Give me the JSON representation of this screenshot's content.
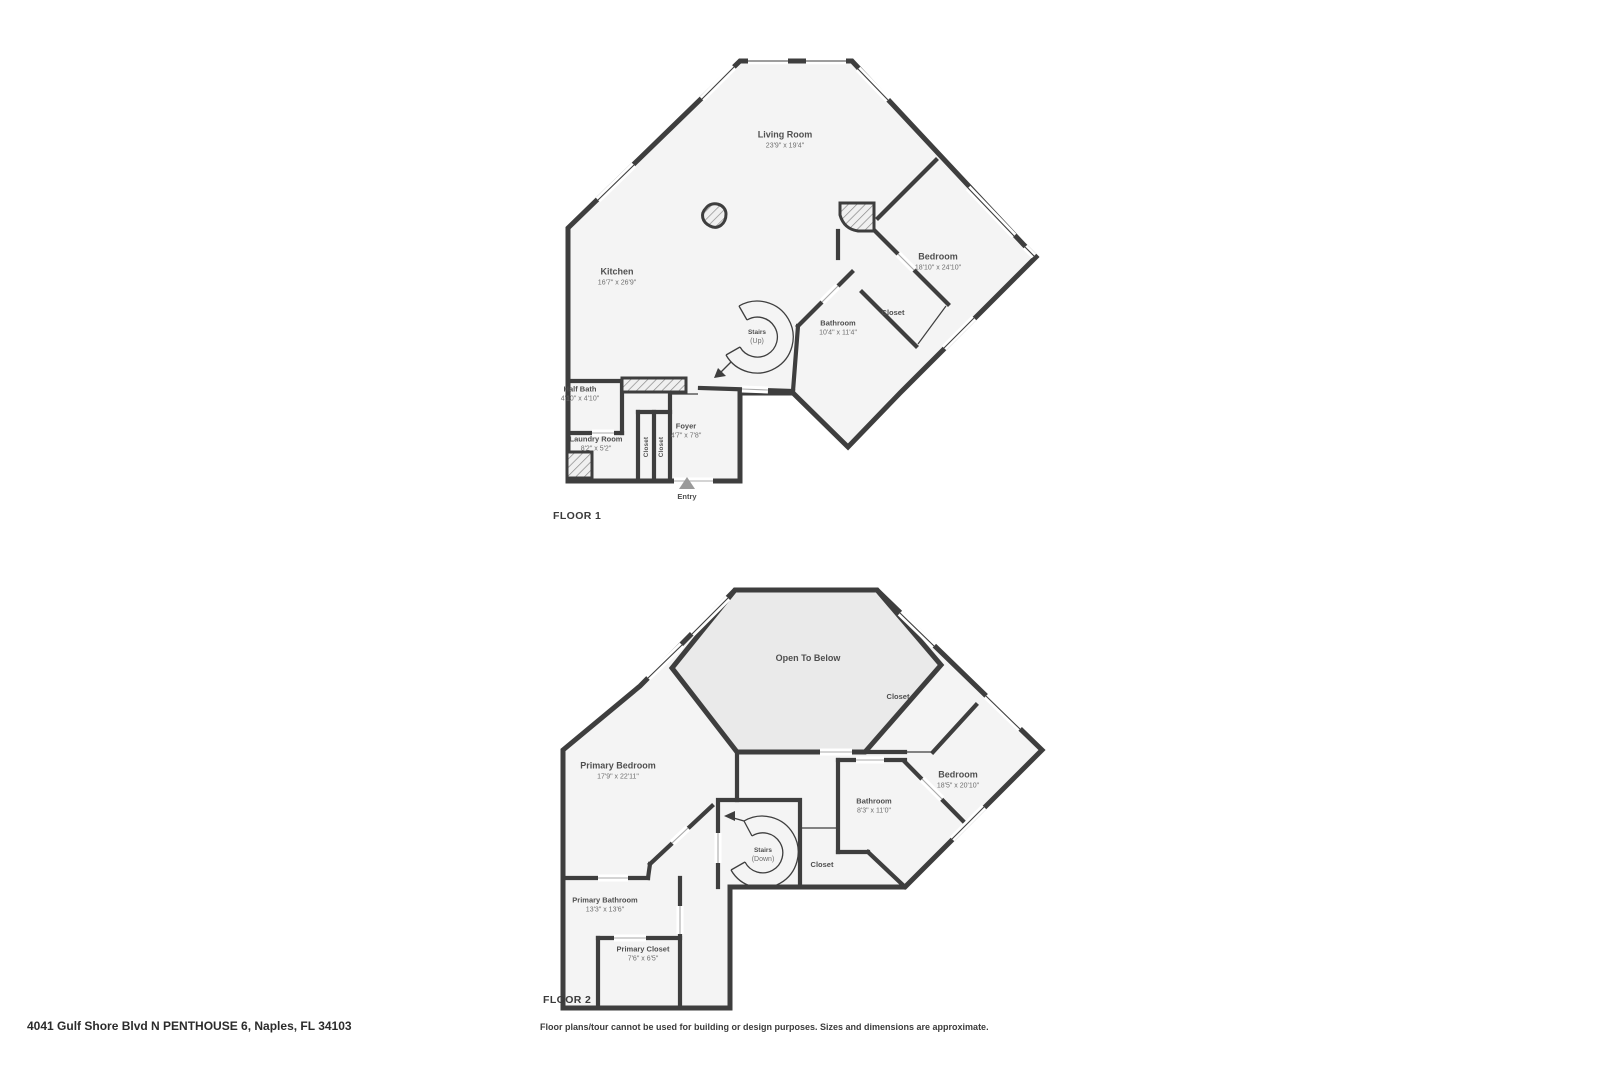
{
  "floor1": {
    "label": "FLOOR 1",
    "rooms": [
      {
        "name": "Living Room",
        "dims": "23'9\" x 19'4\""
      },
      {
        "name": "Kitchen",
        "dims": "16'7\" x 26'9\""
      },
      {
        "name": "Bedroom",
        "dims": "18'10\" x 24'10\""
      },
      {
        "name": "Bathroom",
        "dims": "10'4\" x 11'4\""
      },
      {
        "name": "Closet",
        "dims": ""
      },
      {
        "name": "Half Bath",
        "dims": "4'10\" x 4'10\""
      },
      {
        "name": "Laundry Room",
        "dims": "8'2\" x 5'2\""
      },
      {
        "name": "Closet",
        "dims": ""
      },
      {
        "name": "Closet",
        "dims": ""
      },
      {
        "name": "Foyer",
        "dims": "4'7\" x 7'8\""
      },
      {
        "name": "Stairs",
        "dims": "(Up)"
      },
      {
        "name": "Entry",
        "dims": ""
      }
    ]
  },
  "floor2": {
    "label": "FLOOR 2",
    "rooms": [
      {
        "name": "Open To Below",
        "dims": ""
      },
      {
        "name": "Closet",
        "dims": ""
      },
      {
        "name": "Primary Bedroom",
        "dims": "17'9\" x 22'11\""
      },
      {
        "name": "Bedroom",
        "dims": "18'5\" x 20'10\""
      },
      {
        "name": "Bathroom",
        "dims": "8'3\" x 11'0\""
      },
      {
        "name": "Stairs",
        "dims": "(Down)"
      },
      {
        "name": "Closet",
        "dims": ""
      },
      {
        "name": "Primary Bathroom",
        "dims": "13'3\" x 13'6\""
      },
      {
        "name": "Primary Closet",
        "dims": "7'6\" x 6'5\""
      }
    ]
  },
  "footer": {
    "address": "4041 Gulf Shore Blvd N PENTHOUSE 6, Naples, FL 34103",
    "disclaimer": "Floor plans/tour cannot be used for building or design purposes. Sizes and dimensions are approximate."
  },
  "colors": {
    "walls": "#3e3e3e",
    "room_fill": "#f4f4f4",
    "open_to_below_fill": "#eaeaea",
    "entry_arrow": "#9a9a9a"
  }
}
